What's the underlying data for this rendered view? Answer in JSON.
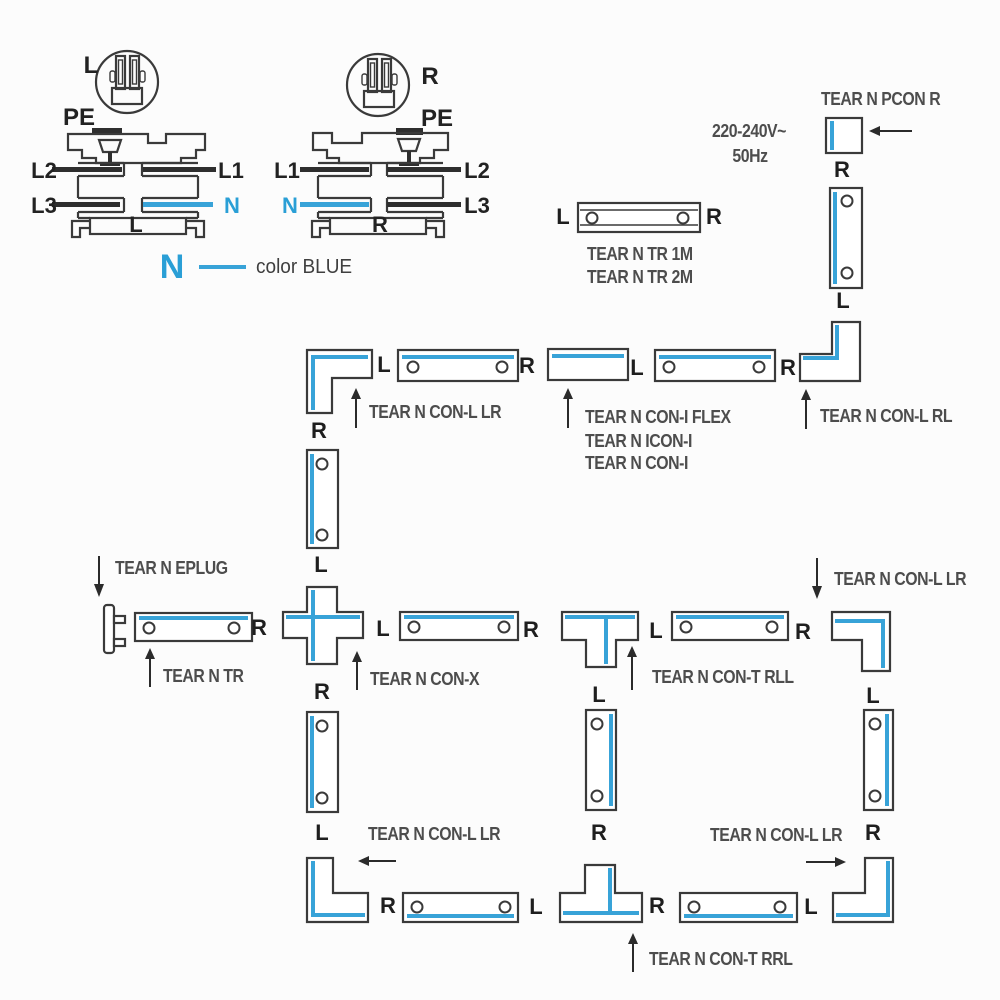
{
  "colors": {
    "accent_blue": "#38a3d8",
    "outline": "#3a3a3a",
    "label": "#1e1e1e",
    "caption": "#4d4d4d",
    "background": "#fcfcfc"
  },
  "pinouts": {
    "left": {
      "circle_label": "L",
      "pe": "PE",
      "t1_left": "L2",
      "t1_right": "L1",
      "t2_left": "L3",
      "t2_right": "N",
      "bottom": "L"
    },
    "right": {
      "circle_label": "R",
      "pe": "PE",
      "t1_left": "L1",
      "t1_right": "L2",
      "t2_left": "N",
      "t2_right": "L3",
      "bottom": "R"
    }
  },
  "legend": {
    "symbol": "N",
    "text": "color BLUE"
  },
  "power": {
    "voltage": "220-240V~",
    "frequency": "50Hz"
  },
  "captions": {
    "pcon": "TEAR N PCON R",
    "tr_1m": "TEAR N TR 1M",
    "tr_2m": "TEAR N TR 2M",
    "con_l_lr_row2": "TEAR N CON-L LR",
    "con_i_flex": "TEAR N CON-I FLEX",
    "icon_i": "TEAR N ICON-I",
    "con_i": "TEAR N CON-I",
    "con_l_rl": "TEAR N CON-L RL",
    "eplug": "TEAR N EPLUG",
    "tr": "TEAR N TR",
    "con_x": "TEAR N CON-X",
    "con_t_rll": "TEAR N CON-T RLL",
    "con_l_lr_mid_right": "TEAR N CON-L LR",
    "con_l_lr_bottom_left": "TEAR N CON-L LR",
    "con_l_lr_bottom_right": "TEAR N CON-L LR",
    "con_t_rrl": "TEAR N CON-T RRL"
  },
  "ports": {
    "p01": "L",
    "p02": "R",
    "p03": "R",
    "p04": "L",
    "p05": "L",
    "p06": "R",
    "p07": "L",
    "p08": "R",
    "p09": "R",
    "p10": "L",
    "p11": "L",
    "p12": "R",
    "p13": "L",
    "p14": "R",
    "p15": "L",
    "p16": "R",
    "p17": "R",
    "p18": "L",
    "p19": "L",
    "p20": "R",
    "p21": "R",
    "p22": "L",
    "p23": "R",
    "p24": "L",
    "p25": "R"
  }
}
